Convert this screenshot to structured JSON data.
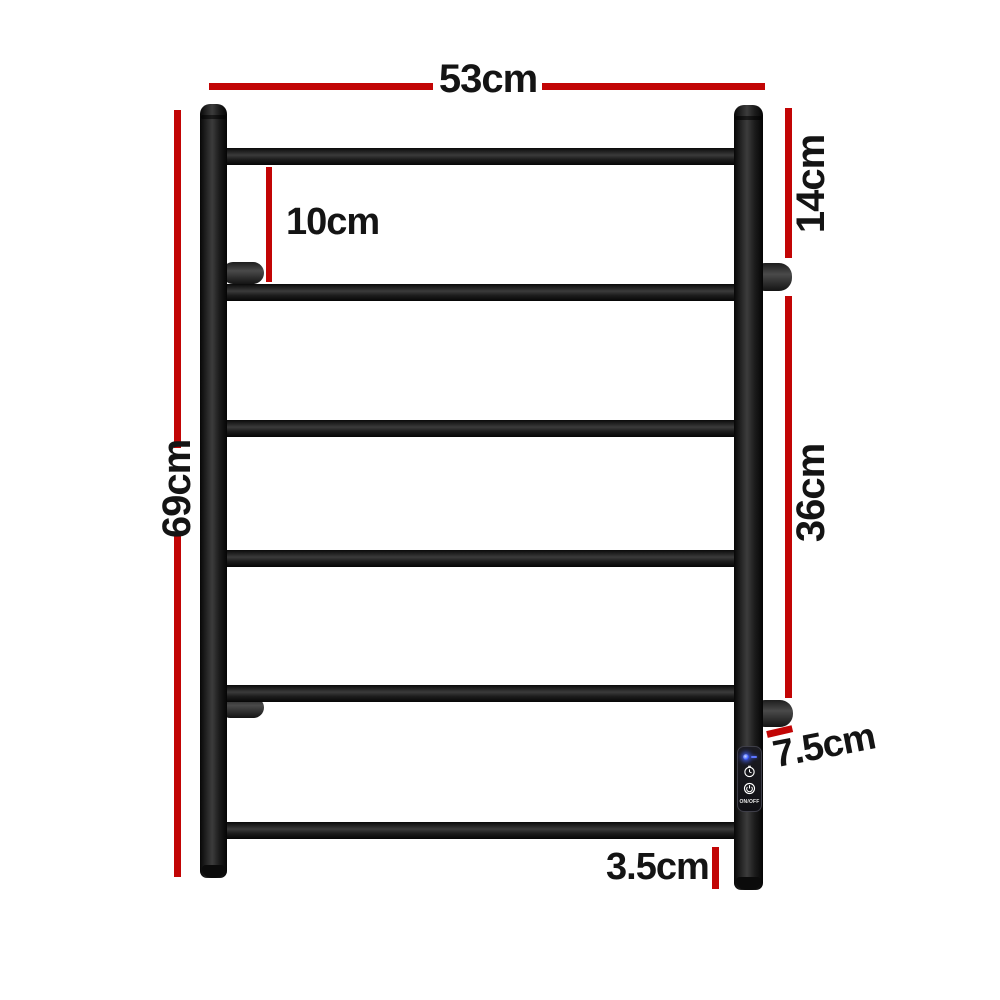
{
  "diagram": {
    "type": "product-dimension-diagram",
    "product": "Electric heated towel rail, 6 rungs, matte black",
    "rung_count": 6,
    "labels": {
      "width": "53cm",
      "height": "69cm",
      "top_section": "14cm",
      "mid_section": "36cm",
      "first_rung_gap": "10cm",
      "bracket_depth": "7.5cm",
      "bottom_stub": "3.5cm"
    },
    "control_panel": {
      "onoff": "ON/OFF",
      "icons": [
        "led-indicator",
        "timer-icon",
        "power-icon"
      ]
    },
    "colors": {
      "dimension_red": "#c20505",
      "label_text": "#141414",
      "rail_black": "#1e1e1e",
      "led_blue": "#4f6bff",
      "background": "#ffffff"
    }
  }
}
